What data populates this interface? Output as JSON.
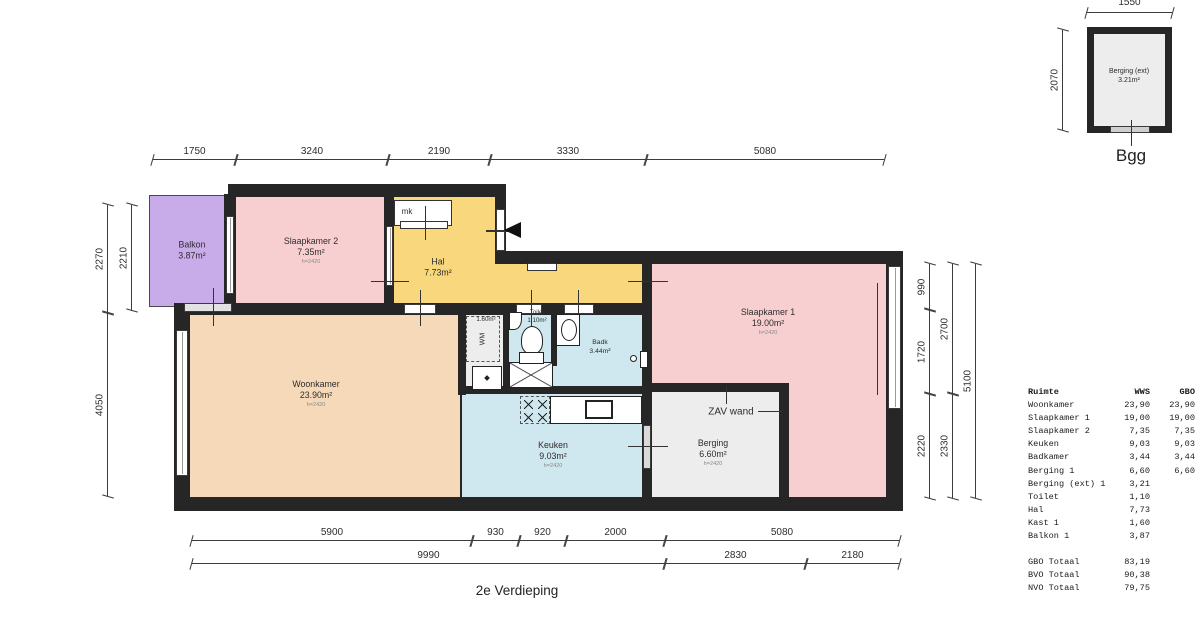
{
  "floor_label": "2e Verdieping",
  "rooms": {
    "balkon": {
      "name": "Balkon",
      "area": "3.87m²"
    },
    "slaapkamer2": {
      "name": "Slaapkamer 2",
      "area": "7.35m²",
      "height": "h=2420"
    },
    "hal": {
      "name": "Hal",
      "area": "7.73m²"
    },
    "mk": {
      "name": "mk"
    },
    "slaapkamer1": {
      "name": "Slaapkamer 1",
      "area": "19.00m²",
      "height": "h=2420"
    },
    "woonkamer": {
      "name": "Woonkamer",
      "area": "23.90m²",
      "height": "h=2420"
    },
    "kast": {
      "name": "K",
      "area": "1.60m²"
    },
    "wm": {
      "name": "WM"
    },
    "toilet": {
      "name": "Toilet",
      "area": "1.10m²"
    },
    "badkamer": {
      "name": "Badk",
      "area": "3.44m²"
    },
    "keuken": {
      "name": "Keuken",
      "area": "9.03m²",
      "height": "h=2420"
    },
    "berging": {
      "name": "Berging",
      "area": "6.60m²",
      "height": "h=2420"
    },
    "zav_wand": {
      "name": "ZAV wand"
    }
  },
  "dimensions": {
    "top": [
      "1750",
      "3240",
      "2190",
      "3330",
      "5080"
    ],
    "left_outer": [
      "2270",
      "4050"
    ],
    "left_inner": [
      "2210"
    ],
    "right_col1": [
      "990",
      "1720",
      "2220"
    ],
    "right_col2": [
      "2700",
      "2330"
    ],
    "right_col3": [
      "5100"
    ],
    "bottom_row1": [
      "5900",
      "930",
      "920",
      "2000",
      "5080"
    ],
    "bottom_row2": [
      "9990",
      "2830",
      "2180"
    ]
  },
  "inset": {
    "top_dim": "1550",
    "left_dim": "2070",
    "room_name": "Berging (ext)",
    "room_area": "3.21m²",
    "caption": "Bgg"
  },
  "table": {
    "headers": [
      "Ruimte",
      "WWS",
      "GBO"
    ],
    "rows": [
      {
        "name": "Woonkamer",
        "wws": "23,90",
        "gbo": "23,90"
      },
      {
        "name": "Slaapkamer 1",
        "wws": "19,00",
        "gbo": "19,00"
      },
      {
        "name": "Slaapkamer 2",
        "wws": "7,35",
        "gbo": "7,35"
      },
      {
        "name": "Keuken",
        "wws": "9,03",
        "gbo": "9,03"
      },
      {
        "name": "Badkamer",
        "wws": "3,44",
        "gbo": "3,44"
      },
      {
        "name": "Berging 1",
        "wws": "6,60",
        "gbo": "6,60"
      },
      {
        "name": "Berging (ext) 1",
        "wws": "3,21",
        "gbo": ""
      },
      {
        "name": "Toilet",
        "wws": "1,10",
        "gbo": ""
      },
      {
        "name": "Hal",
        "wws": "7,73",
        "gbo": ""
      },
      {
        "name": "Kast 1",
        "wws": "1,60",
        "gbo": ""
      },
      {
        "name": "Balkon 1",
        "wws": "3,87",
        "gbo": ""
      }
    ],
    "totals": [
      {
        "name": "GBO Totaal",
        "value": "83,19"
      },
      {
        "name": "BVO Totaal",
        "value": "90,38"
      },
      {
        "name": "NVO Totaal",
        "value": "79,75"
      }
    ]
  },
  "colors": {
    "wall": "#262626",
    "bedroom_pink": "#f8cfd1",
    "balcony_purple": "#c8abe9",
    "hall_yellow": "#f8d77d",
    "living_peach": "#f6d9b8",
    "wet_room_blue": "#cfe7ee",
    "storage_grey": "#ededed"
  }
}
